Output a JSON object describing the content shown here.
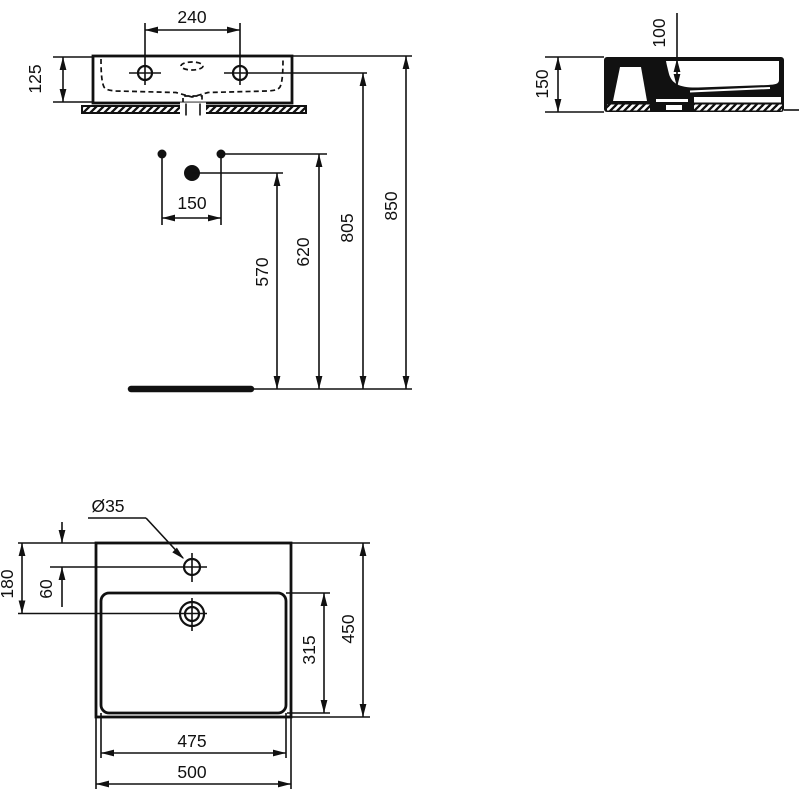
{
  "page": {
    "background": "#ffffff",
    "line_color": "#111111"
  },
  "dims": {
    "front": {
      "fixing_spacing": "240",
      "body_height": "125",
      "supply_spacing": "150",
      "trap_height": "570",
      "supply_height": "620",
      "fixing_height": "805",
      "rim_height": "850"
    },
    "side": {
      "bowl_depth": "100",
      "body_height": "150"
    },
    "plan": {
      "tap_hole_diameter": "Ø35",
      "drain_offset": "180",
      "tap_offset": "60",
      "overall_depth": "450",
      "bowl_depth": "315",
      "bowl_width": "475",
      "overall_width": "500"
    }
  }
}
